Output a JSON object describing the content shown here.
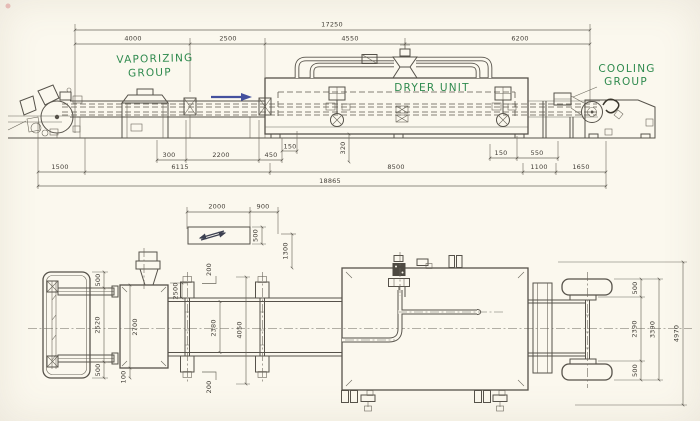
{
  "drawing": {
    "title": "Machine layout drawing - vaporizing group, dryer unit, cooling group",
    "colors": {
      "paper": "#fbf8ee",
      "ink": "#56524a",
      "annotation_green": "#2f8a4e",
      "arrow_blue": "#44519e"
    },
    "annotations": {
      "vaporizing_line1": "VAPORIZING",
      "vaporizing_line2": "GROUP",
      "dryer_unit": "DRYER UNIT",
      "cooling_line1": "COOLING",
      "cooling_line2": "GROUP"
    },
    "side_view": {
      "overall_length": "17250",
      "seg_4000": "4000",
      "seg_2500": "2500",
      "seg_4550": "4550",
      "seg_6200": "6200",
      "dim_300": "300",
      "dim_2200": "2200",
      "dim_450": "450",
      "dim_150_left": "150",
      "dim_320": "320",
      "dim_150_right": "150",
      "dim_550": "550",
      "dim_1500": "1500",
      "dim_6115": "6115",
      "dim_8500": "8500",
      "dim_1100": "1100",
      "dim_1650": "1650",
      "overall_with_winders": "18865"
    },
    "plan_view": {
      "dim_2000": "2000",
      "dim_900": "900",
      "dim_500_symbol": "500",
      "dim_1300": "1300",
      "dim_500_unwinder_top": "500",
      "dim_2520": "2520",
      "dim_500_unwinder_bottom": "500",
      "dim_2700": "2700",
      "dim_100": "100",
      "dim_2500": "2500",
      "dim_200_top": "200",
      "dim_2380": "2380",
      "dim_4050": "4050",
      "dim_200_bottom": "200",
      "dim_500_rewinder_top": "500",
      "dim_2390": "2390",
      "dim_3390": "3390",
      "dim_4970": "4970",
      "dim_500_rewinder_bottom": "500"
    }
  }
}
